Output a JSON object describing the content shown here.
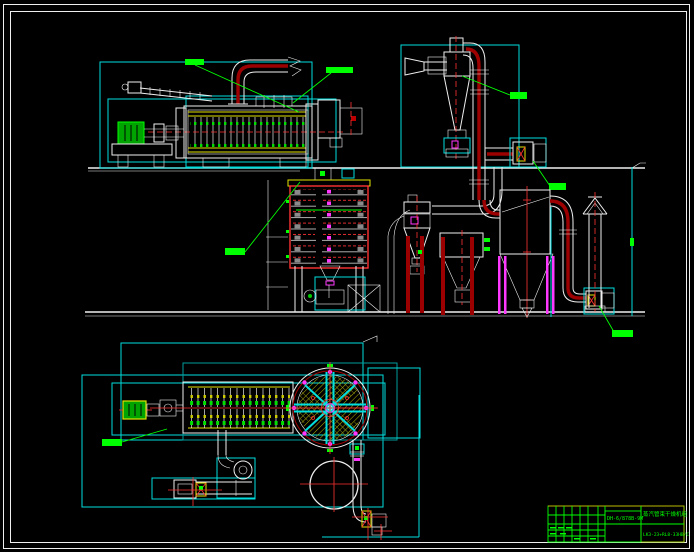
{
  "app": {
    "type": "cad-drawing",
    "background": "#000000"
  },
  "palette": {
    "line_white": "#efefef",
    "line_cyan": "#00dede",
    "line_teal": "#009c9c",
    "line_green": "#00ff00",
    "line_yellow": "#e3e300",
    "line_red": "#ff3232",
    "line_dark_red": "#9c0000",
    "line_magenta": "#ff38ff",
    "callout_fill": "#00ff00"
  },
  "title_block": {
    "drawing_code": "DH-6/878B-9M",
    "drawing_title": "蒸汽管束干燥机组",
    "spec_code": "LK3-23+RL8-33HB/C"
  }
}
